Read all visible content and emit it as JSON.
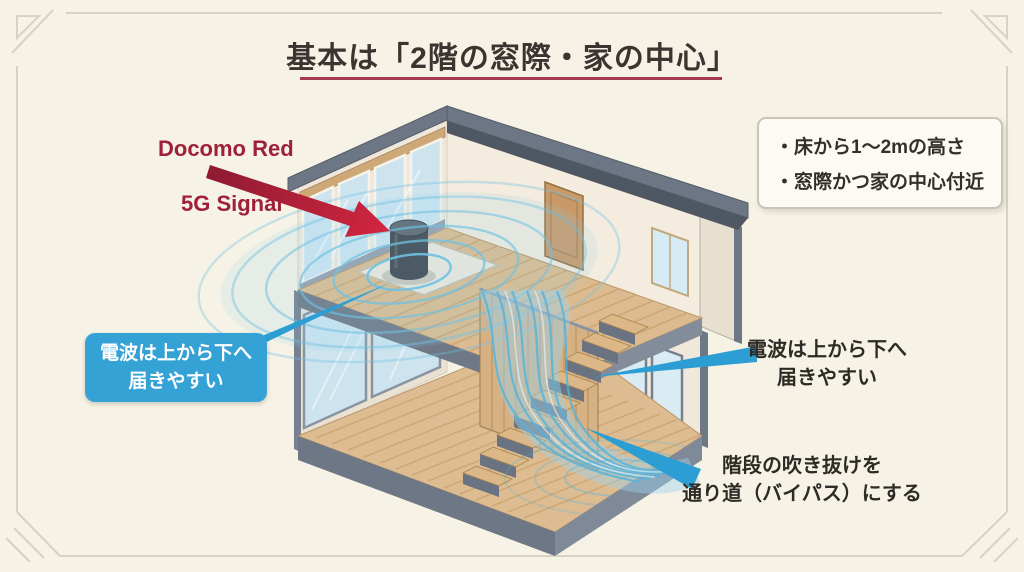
{
  "slide": {
    "title": "基本は「2階の窓際・家の中心」"
  },
  "signal_label": {
    "line1": "Docomo Red",
    "line2": "5G Signal"
  },
  "tips_box": {
    "items": [
      "・床から1〜2mの高さ",
      "・窓際かつ家の中心付近"
    ]
  },
  "callout_left": {
    "line1": "電波は上から下へ",
    "line2": "届きやすい"
  },
  "annotation_right": {
    "line1": "電波は上から下へ",
    "line2": "届きやすい"
  },
  "annotation_bottom": {
    "line1": "階段の吹き抜けを",
    "line2": "通り道（バイパス）にする"
  },
  "icons": {
    "signal_arrow": "red-diagonal-arrow",
    "wifi_waves": "concentric-blue-arcs",
    "router_device": "dark-cylinder-5g-router",
    "signal_stream": "blue-wave-flow-down-stairs"
  },
  "colors": {
    "background": "#f6f2e6",
    "accent_red": "#9e2138",
    "title_underline": "#a43a50",
    "callout_blue": "#35a2d6",
    "wave_blue": "#54b3dc",
    "roof_gray": "#6d7684",
    "wood": "#ddbb90"
  }
}
